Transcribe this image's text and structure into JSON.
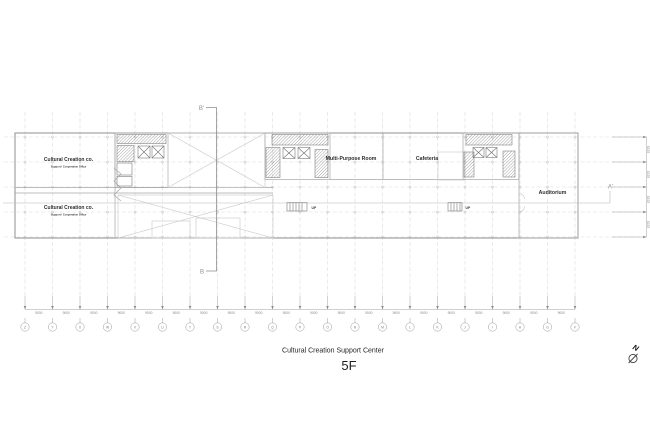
{
  "drawing": {
    "title": "Cultural Creation Support Center",
    "floor": "5F"
  },
  "rooms": {
    "upper_office": {
      "name": "Cultural Creation co.",
      "subtitle": "Support / Cooperation Office"
    },
    "lower_office": {
      "name": "Cultural Creation co.",
      "subtitle": "Support / Cooperation Office"
    },
    "multi_purpose": {
      "name": "Multi-Purpose Room"
    },
    "cafeteria": {
      "name": "Cafeteria"
    },
    "auditorium": {
      "name": "Auditorium"
    }
  },
  "stairs": {
    "up_left": "UP",
    "up_right": "UP"
  },
  "section_markers": {
    "b_prime": "B'",
    "b": "B",
    "a_prime": "A'"
  },
  "north_arrow": {
    "label": "N"
  },
  "grid": {
    "column_labels": [
      "Z",
      "Y",
      "X",
      "W",
      "V",
      "U",
      "T",
      "S",
      "R",
      "Q",
      "P",
      "O",
      "N",
      "M",
      "L",
      "K",
      "J",
      "I",
      "H",
      "G",
      "F"
    ],
    "bay_dimension": "9000",
    "row_dimension": "8100"
  },
  "colors": {
    "grid_line": "#dcdcdc",
    "wall": "#8f8f8f",
    "dimension": "#9a9a9a",
    "text": "#2e2e2e"
  }
}
